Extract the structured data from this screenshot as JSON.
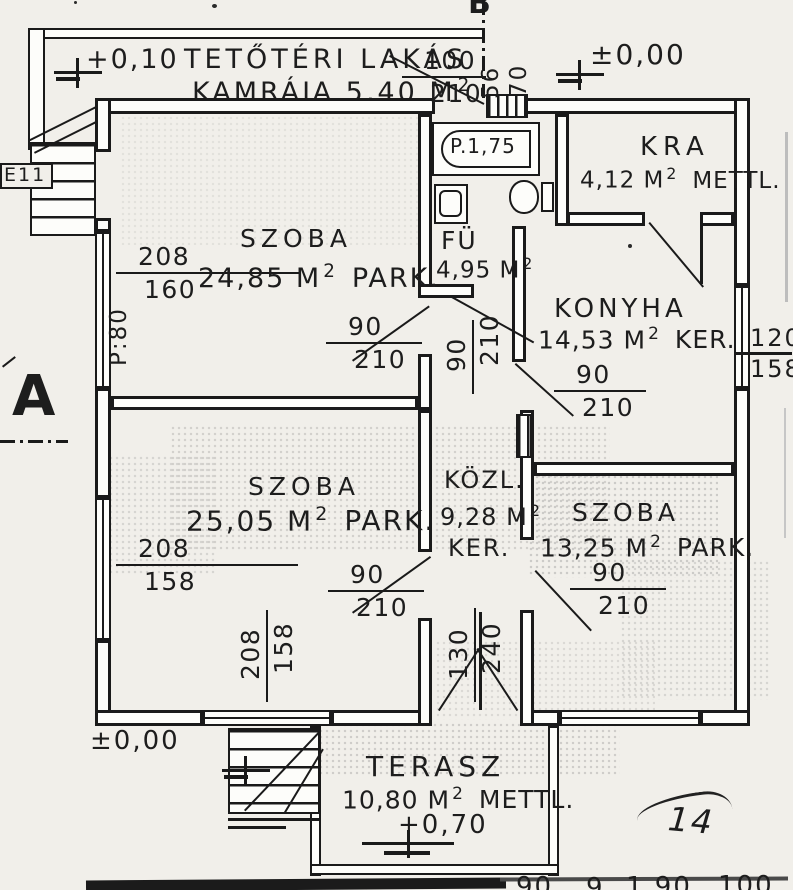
{
  "levels": {
    "annex": "+0,10",
    "upper_right": "±0,00",
    "lower_left": "±0,00",
    "terrace": "+0,70"
  },
  "annex_label": {
    "line1": "TETŐTÉRI LAKÁS",
    "line2": "KAMRÁJA 5,40 M",
    "sup": "2"
  },
  "rooms": {
    "szoba1": {
      "name": "SZOBA",
      "area": "24,85 M",
      "sup": "2",
      "suffix": "PARK."
    },
    "fu": {
      "name": "FÜ",
      "area": "4,95 M",
      "sup": "2",
      "suffix": ""
    },
    "kra": {
      "name": "KRA",
      "area": "4,12 M",
      "sup": "2",
      "suffix": "METTL."
    },
    "konyha": {
      "name": "KONYHA",
      "area": "14,53 M",
      "sup": "2",
      "suffix": "KER."
    },
    "szoba2": {
      "name": "SZOBA",
      "area": "25,05 M",
      "sup": "2",
      "suffix": "PARK."
    },
    "kozl": {
      "name": "KÖZL.",
      "area": "9,28 M",
      "sup": "2",
      "suffix": "KER."
    },
    "szoba3": {
      "name": "SZOBA",
      "area": "13,25 M",
      "sup": "2",
      "suffix": "PARK."
    },
    "terasz": {
      "name": "TERASZ",
      "area": "10,80 M",
      "sup": "2",
      "suffix": "METTL."
    }
  },
  "fixtures": {
    "bathtub_label": "P.1,75"
  },
  "dims": {
    "entry_door": {
      "top": "100",
      "bottom": "210"
    },
    "entry_step_depth": "56",
    "entry_step_width": "70",
    "window_left_upper": {
      "top": "208",
      "bottom": "160"
    },
    "parapet_left": "P:80",
    "door_szoba1": {
      "top": "90",
      "bottom": "210"
    },
    "door_bathroom": {
      "top": "90",
      "bottom": "210"
    },
    "door_konyha": {
      "top": "90",
      "bottom": "210"
    },
    "window_right": {
      "top": "120",
      "bottom": "158"
    },
    "door_szoba2": {
      "top": "90",
      "bottom": "210"
    },
    "door_szoba3": {
      "top": "90",
      "bottom": "210"
    },
    "window_left_lower": {
      "top": "208",
      "bottom": "158"
    },
    "window_bottom": {
      "top": "208",
      "bottom": "158"
    },
    "terrace_door": {
      "top": "130",
      "bottom": "240"
    }
  },
  "markers": {
    "section_a": "A",
    "section_b": "B",
    "entry_label": "E11",
    "page_number": "14"
  },
  "footer_fragments": {
    "f1": "90",
    "f2": "9",
    "f3": "1,90",
    "f4": "100"
  }
}
